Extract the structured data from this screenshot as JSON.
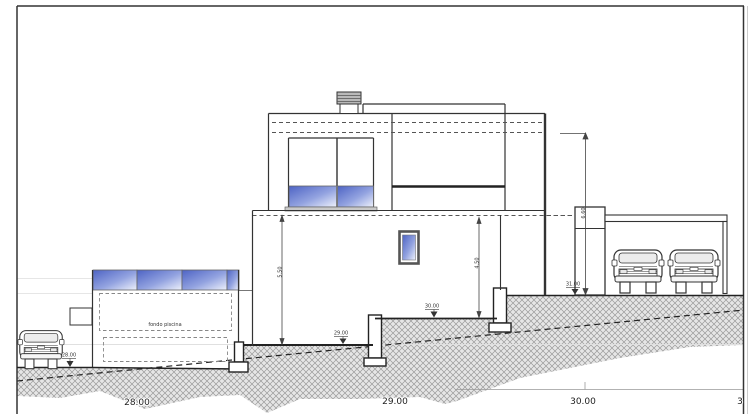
{
  "page": {
    "background": "#ffffff",
    "line_color": "#2a2a2a",
    "hatch_line_color": "#9a9a9a",
    "hatch_bg_color": "#e6e6e6",
    "glass_blue": "#4d63c4"
  },
  "drawing": {
    "pool_label": "fondo piscina",
    "spot_elevations": {
      "at_car": "28.00",
      "at_slab": "29.00",
      "at_floor": "30.00",
      "at_garage": "31.00"
    },
    "dimensions": {
      "left_height": "5.50",
      "right_height": "4.50",
      "garage_height": "6.60"
    },
    "baseline_marks": {
      "m28": "28.00",
      "m29": "29.00",
      "m30": "30.00",
      "m31": "3"
    }
  }
}
